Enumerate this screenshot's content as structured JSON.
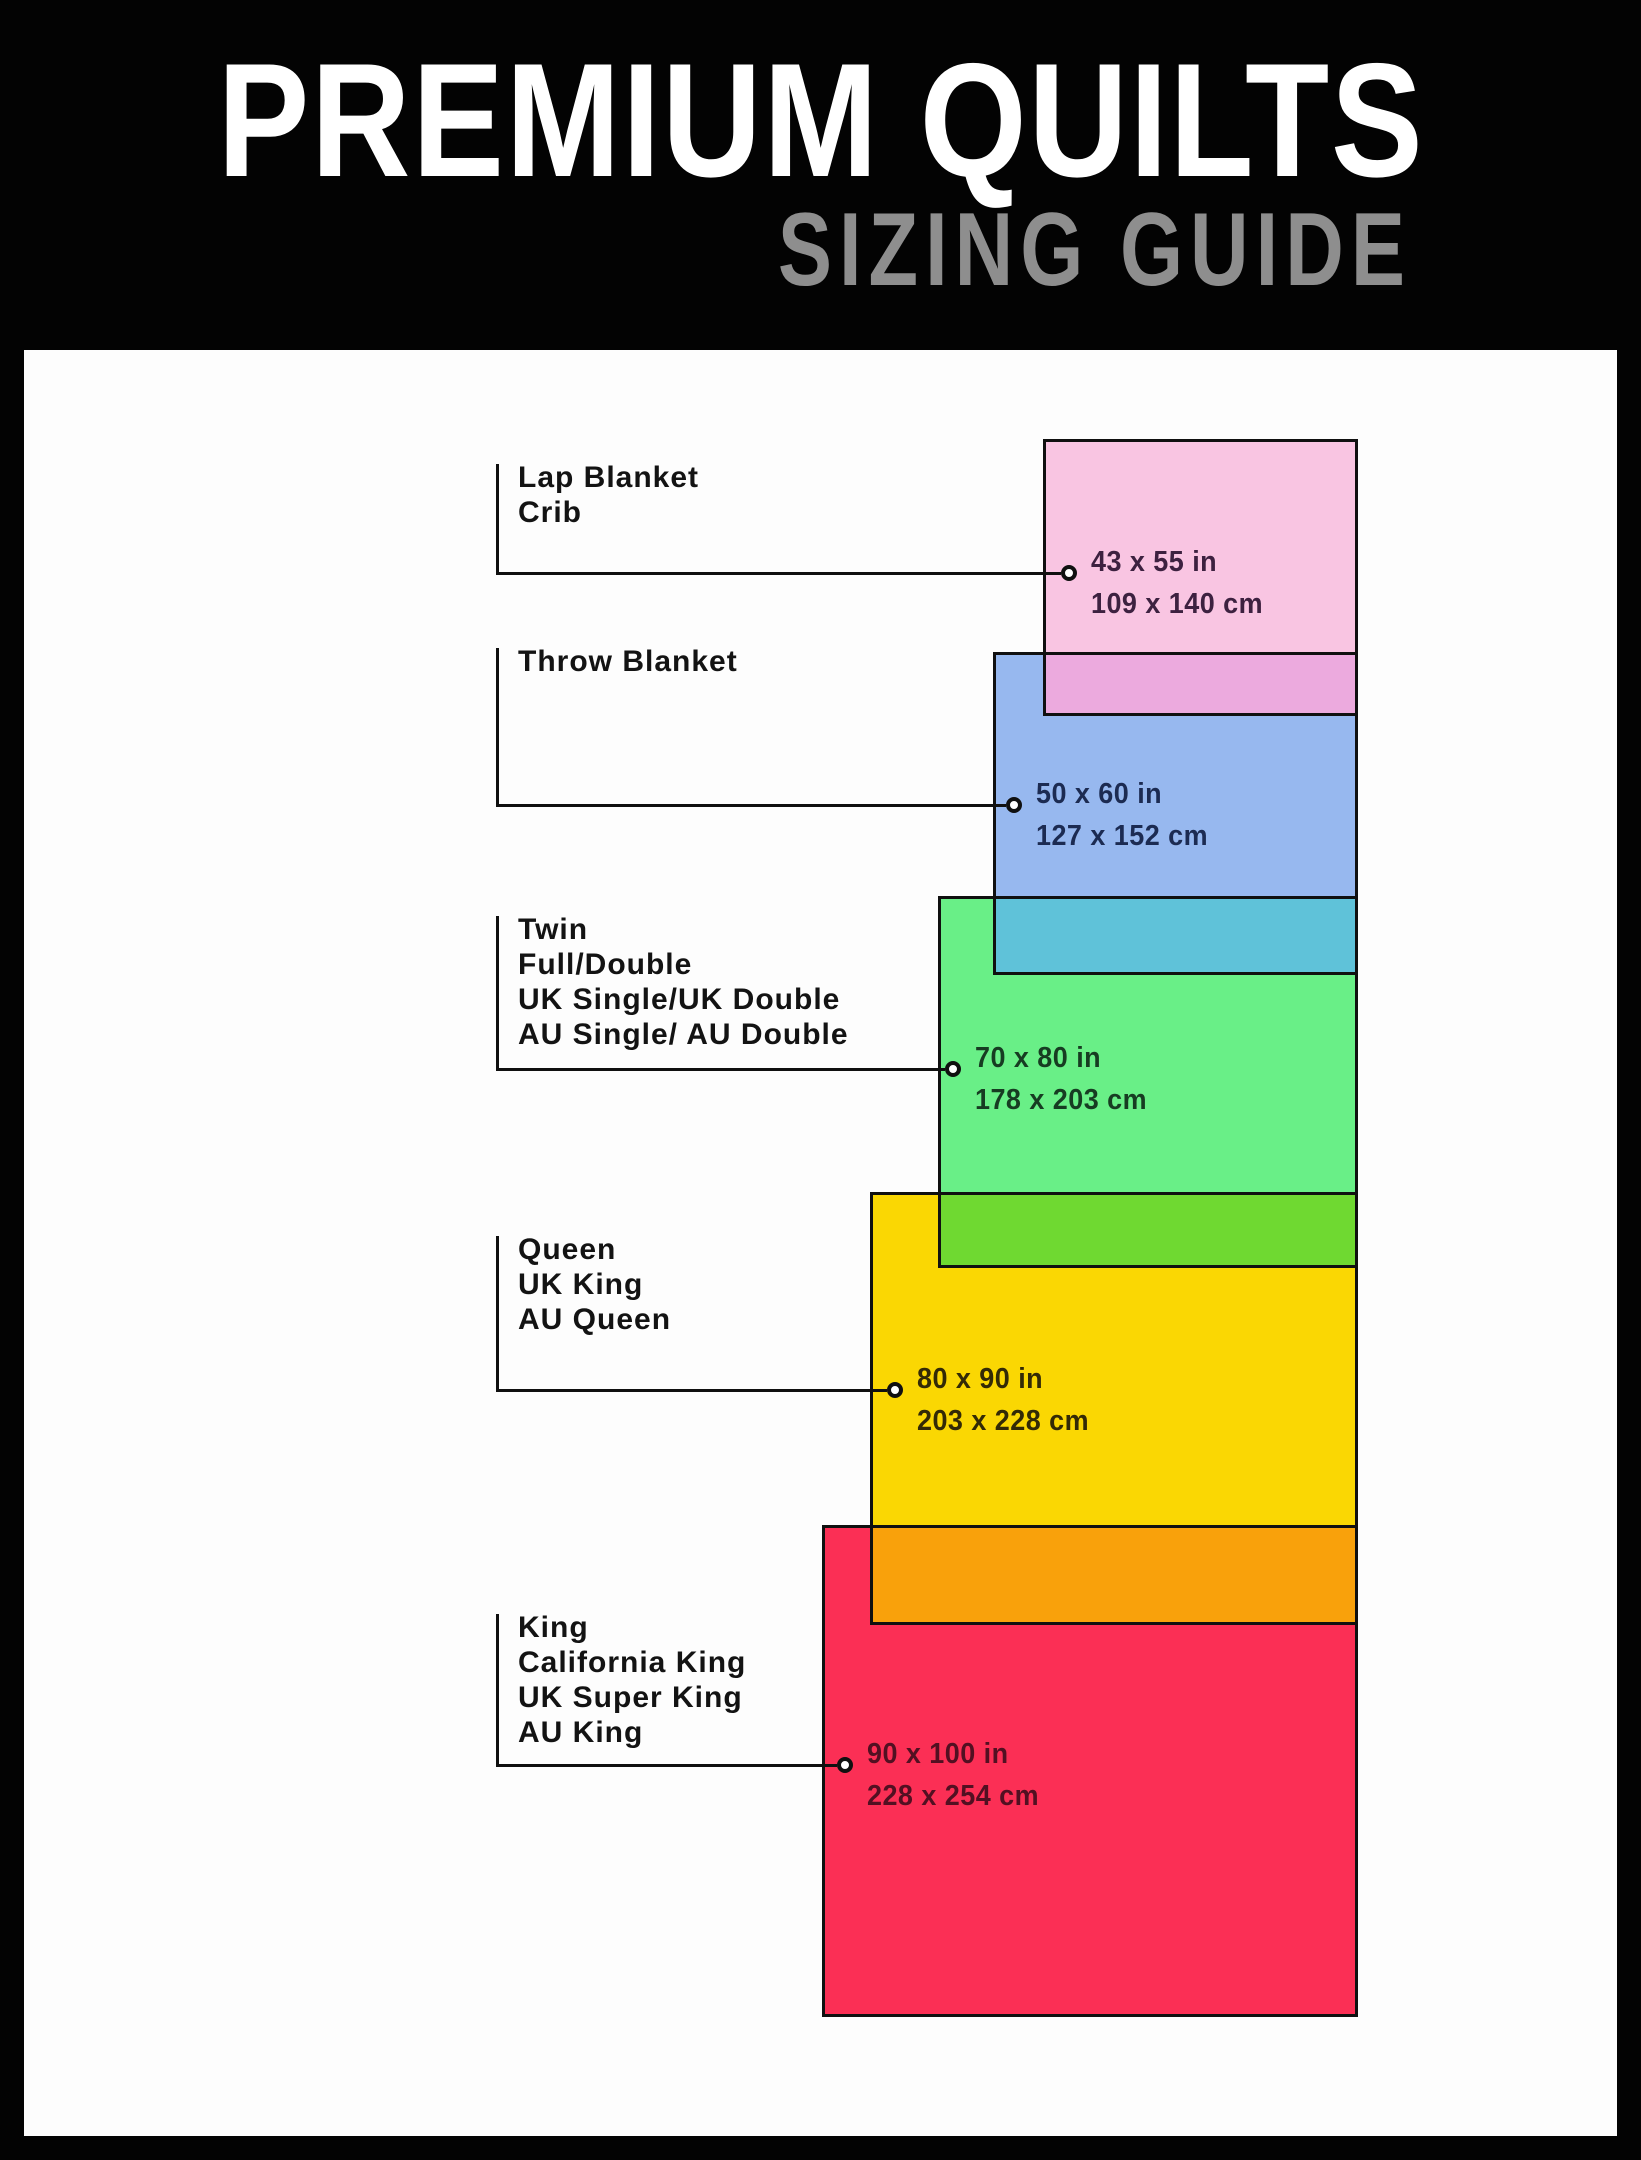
{
  "header": {
    "title": "PREMIUM QUILTS",
    "subtitle": "SIZING GUIDE",
    "title_color": "#ffffff",
    "subtitle_color": "#8e8e8e",
    "background": "#030303"
  },
  "panel": {
    "background": "#fdfdfd"
  },
  "line_color": "#101010",
  "overlap_colors": [
    "#ecaade",
    "#5fc2d9",
    "#6fd931",
    "#f9a10b"
  ],
  "sizes": [
    {
      "id": "lap-blanket-crib",
      "label_lines": [
        "Lap Blanket",
        "Crib"
      ],
      "inches": "43 x 55 in",
      "cm": "109 x 140 cm",
      "fill": "#f9c5e2",
      "text_color": "#3d2140"
    },
    {
      "id": "throw-blanket",
      "label_lines": [
        "Throw Blanket"
      ],
      "inches": "50 x 60 in",
      "cm": "127 x 152 cm",
      "fill": "#97b8ef",
      "text_color": "#1c2b52"
    },
    {
      "id": "twin-full-double",
      "label_lines": [
        "Twin",
        "Full/Double",
        "UK Single/UK Double",
        "AU Single/ AU Double"
      ],
      "inches": "70 x 80 in",
      "cm": "178 x 203 cm",
      "fill": "#69ef87",
      "text_color": "#173c22"
    },
    {
      "id": "queen-uk-king-au-queen",
      "label_lines": [
        "Queen",
        "UK King",
        "AU Queen"
      ],
      "inches": "80 x 90 in",
      "cm": "203 x 228 cm",
      "fill": "#fad703",
      "text_color": "#332a06"
    },
    {
      "id": "king-california-king",
      "label_lines": [
        "King",
        "California King",
        "UK Super King",
        "AU King"
      ],
      "inches": "90 x 100 in",
      "cm": "228 x 254 cm",
      "fill": "#fb2f55",
      "text_color": "#521022"
    }
  ]
}
